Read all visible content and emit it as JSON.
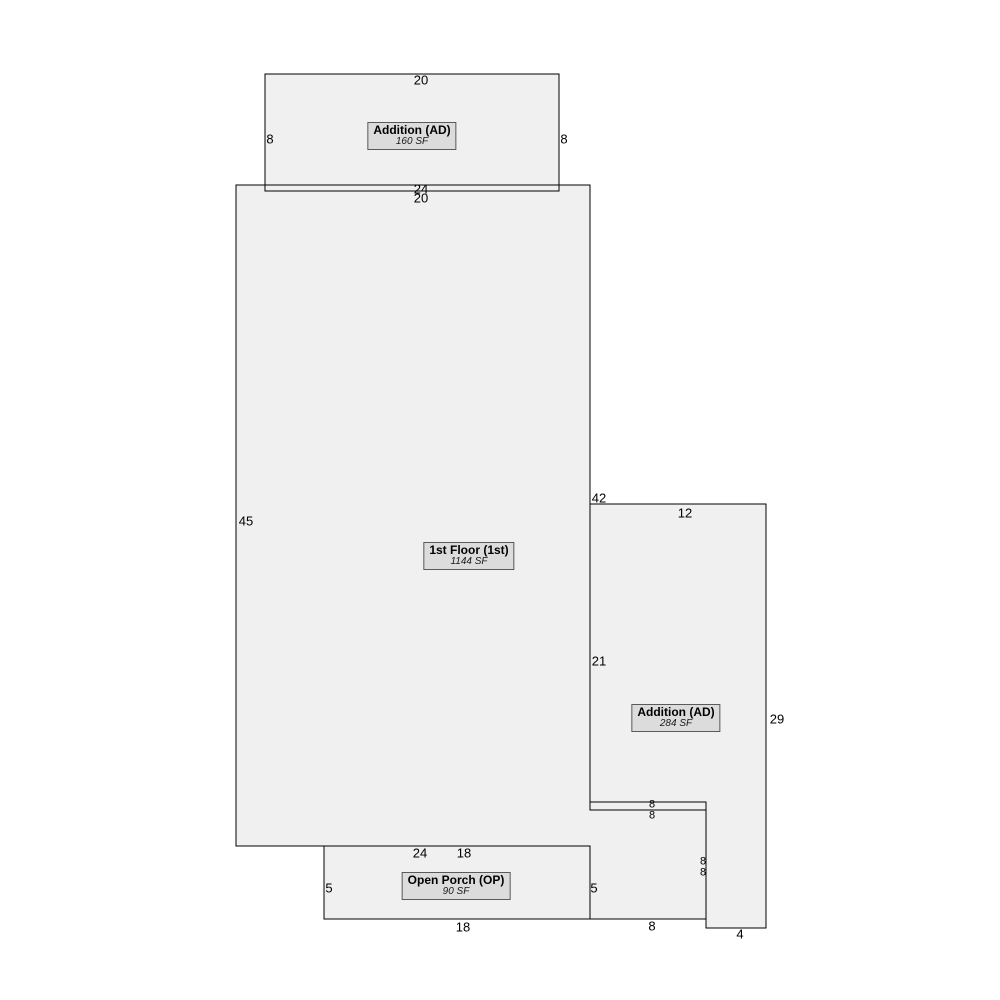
{
  "page": {
    "background": "#ffffff",
    "shape_fill": "#f0f0f0",
    "outline_color": "#000000",
    "label_box_fill": "#dcdcdc",
    "label_box_border": "#5a5a5a"
  },
  "areas": [
    {
      "id": "addition-top",
      "title": "Addition (AD)",
      "area": "160 SF"
    },
    {
      "id": "first-floor",
      "title": "1st Floor (1st)",
      "area": "1144 SF"
    },
    {
      "id": "addition-right",
      "title": "Addition (AD)",
      "area": "284 SF"
    },
    {
      "id": "open-porch",
      "title": "Open Porch (OP)",
      "area": "90 SF"
    }
  ],
  "dimensions": [
    {
      "value": "20",
      "of": "addition-top-top-edge"
    },
    {
      "value": "8",
      "of": "addition-top-left-edge"
    },
    {
      "value": "8",
      "of": "addition-top-right-edge"
    },
    {
      "value": "24",
      "of": "first-floor-top-edge"
    },
    {
      "value": "20",
      "of": "addition-top-bottom-edge"
    },
    {
      "value": "45",
      "of": "first-floor-left-edge"
    },
    {
      "value": "42",
      "of": "first-floor-right-edge"
    },
    {
      "value": "12",
      "of": "addition-right-top-edge"
    },
    {
      "value": "21",
      "of": "addition-right-left-edge"
    },
    {
      "value": "29",
      "of": "addition-right-right-edge"
    },
    {
      "value": "8",
      "of": "first-floor-step-top-edge"
    },
    {
      "value": "8",
      "of": "addition-right-notch-top-edge"
    },
    {
      "value": "8",
      "of": "first-floor-step-right-edge"
    },
    {
      "value": "8",
      "of": "addition-right-tab-left-edge"
    },
    {
      "value": "8",
      "of": "first-floor-step-bottom-edge"
    },
    {
      "value": "4",
      "of": "addition-right-tab-bottom-edge"
    },
    {
      "value": "24",
      "of": "first-floor-bottom-edge"
    },
    {
      "value": "18",
      "of": "open-porch-top-edge"
    },
    {
      "value": "5",
      "of": "open-porch-left-edge"
    },
    {
      "value": "5",
      "of": "open-porch-right-edge"
    },
    {
      "value": "18",
      "of": "open-porch-bottom-edge"
    }
  ]
}
